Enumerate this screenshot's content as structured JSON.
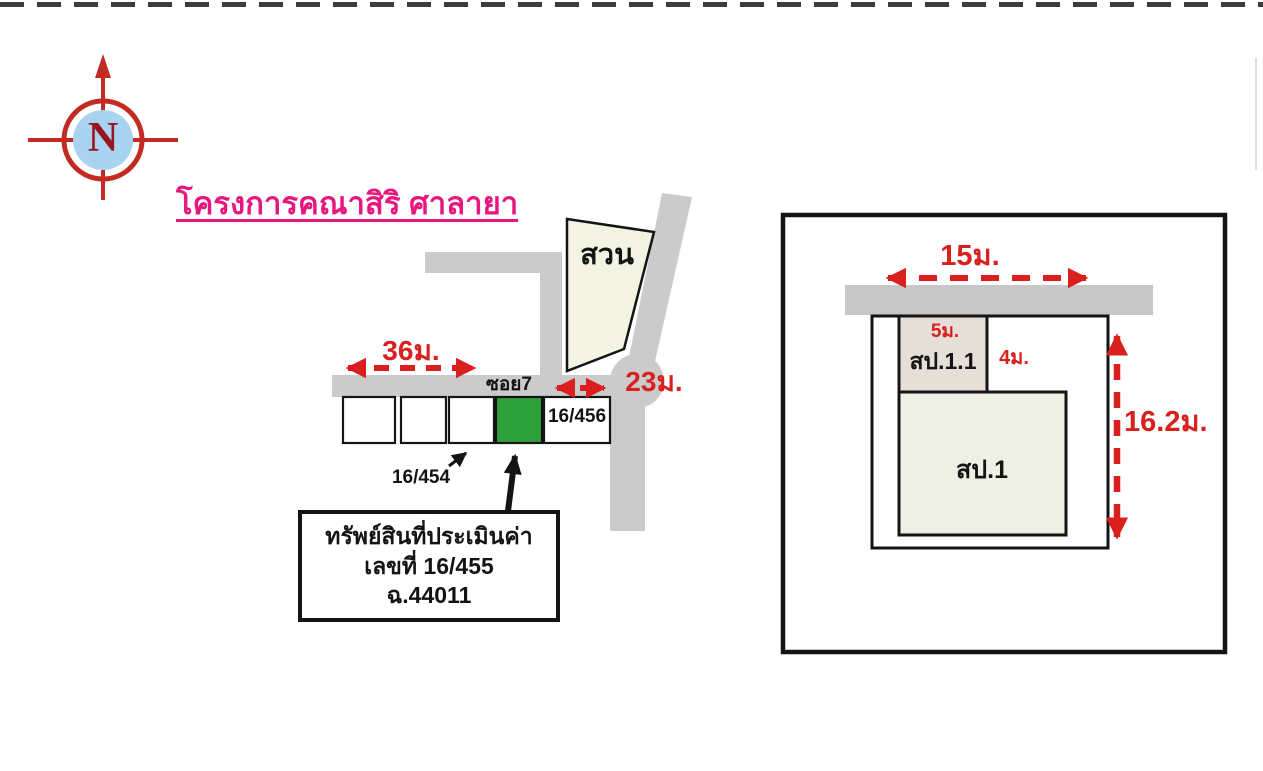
{
  "compass": {
    "letter": "N"
  },
  "title": {
    "text": "โครงการคณาสิริ ศาลายา"
  },
  "site_map": {
    "park_label": "สวน",
    "soi_label": "ซอย7",
    "width_left": "36ม.",
    "width_right": "23ม.",
    "plot_right_label": "16/456",
    "plot_pointer_label": "16/454",
    "callout": {
      "line1": "ทรัพย์สินที่ประเมินค่า",
      "line2": "เลขที่ 16/455",
      "line3": "ฉ.44011"
    }
  },
  "detail_plan": {
    "frontage": "15ม.",
    "building_small_width": "5ม.",
    "building_small_depth": "4ม.",
    "depth": "16.2ม.",
    "building_small_label": "สป.1.1",
    "building_main_label": "สป.1"
  },
  "colors": {
    "dimension_red": "#da1f1f",
    "title_magenta": "#e8177f",
    "subject_plot_green": "#2fa13c",
    "road_gray": "#cbcbcb",
    "park_fill": "#f2f3e2",
    "compass_blue": "#a9d3f1",
    "building_small_fill": "#e6dfd7",
    "building_main_fill": "#eef0e4"
  }
}
